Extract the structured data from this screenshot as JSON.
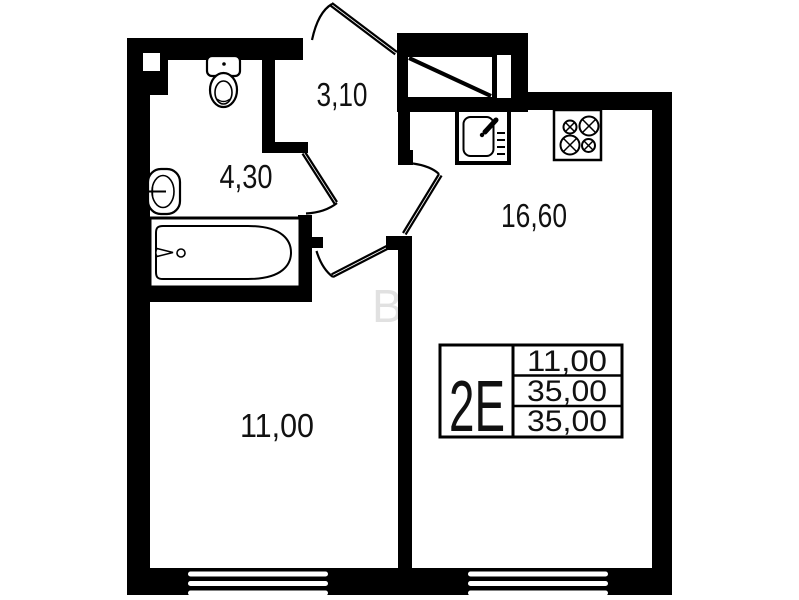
{
  "plan": {
    "unit": {
      "type_label": "2E",
      "table_rows": [
        "11,00",
        "35,00",
        "35,00"
      ]
    },
    "rooms": {
      "hallway": {
        "name": "hallway",
        "area": "3,10"
      },
      "bathroom": {
        "name": "bathroom",
        "area": "4,30"
      },
      "kitchen": {
        "name": "kitchen-living",
        "area": "16,60"
      },
      "living_room": {
        "name": "room",
        "area": "11,00"
      }
    },
    "fixtures": [
      "toilet-icon",
      "washbasin-icon",
      "bathtub-icon",
      "kitchen-sink-icon",
      "stove-icon",
      "wardrobe-icon",
      "entrance-door-icon",
      "window-icon"
    ],
    "watermark": "B",
    "colors": {
      "walls": "#000000",
      "background": "#ffffff",
      "text": "#111111",
      "watermark": "#c9c9c9"
    }
  }
}
